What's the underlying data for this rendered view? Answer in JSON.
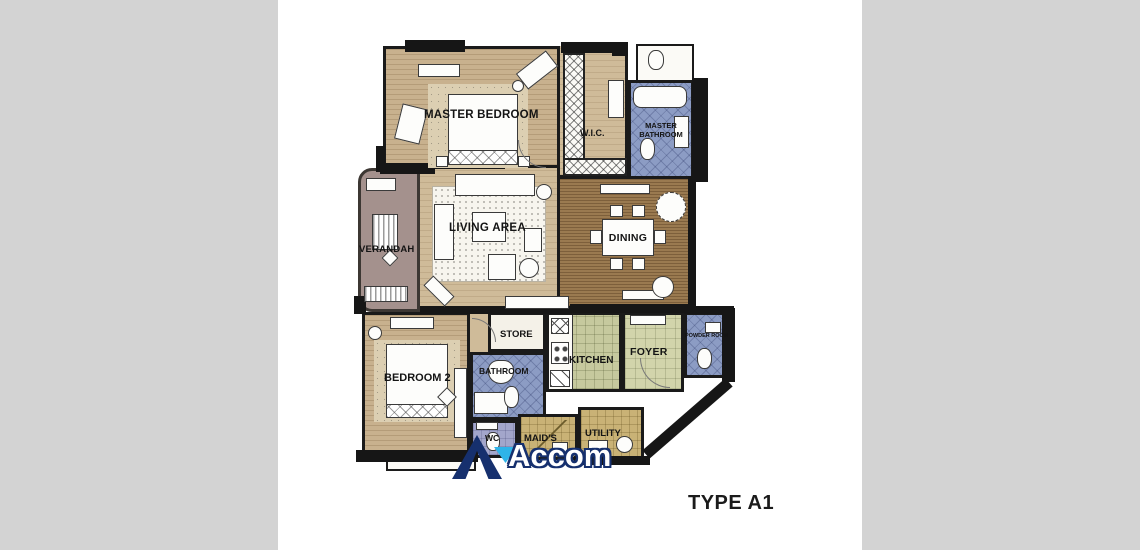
{
  "title": "TYPE A1",
  "watermark": {
    "text": "Accom",
    "logo": "accom-a-logo",
    "navy": "#16306e",
    "cyan": "#2fb4e9"
  },
  "canvas": {
    "background_gray": "#d3d3d3",
    "paper_white": "#ffffff",
    "wall_black": "#161616"
  },
  "colors": {
    "floor_tan": "#c8b18e",
    "wood_brown": "#9a7a50",
    "tile_blue": "#8c9cc4",
    "tile_green": "#c6c99e",
    "tile_khaki": "#c9b276",
    "verandah_mauve": "#a4918d"
  },
  "rooms": [
    {
      "id": "master-bedroom",
      "label": "MASTER BEDROOM"
    },
    {
      "id": "wic",
      "label": "W.I.C."
    },
    {
      "id": "master-bathroom",
      "label": "MASTER BATHROOM"
    },
    {
      "id": "verandah",
      "label": "VERANDAH"
    },
    {
      "id": "living-area",
      "label": "LIVING AREA"
    },
    {
      "id": "dining",
      "label": "DINING"
    },
    {
      "id": "store",
      "label": "STORE"
    },
    {
      "id": "kitchen",
      "label": "KITCHEN"
    },
    {
      "id": "foyer",
      "label": "FOYER"
    },
    {
      "id": "powder-room",
      "label": "POWDER ROOM"
    },
    {
      "id": "bedroom-2",
      "label": "BEDROOM 2"
    },
    {
      "id": "bathroom",
      "label": "BATHROOM"
    },
    {
      "id": "wc",
      "label": "WC"
    },
    {
      "id": "maids",
      "label": "MAID'S"
    },
    {
      "id": "utility",
      "label": "UTILITY"
    }
  ]
}
